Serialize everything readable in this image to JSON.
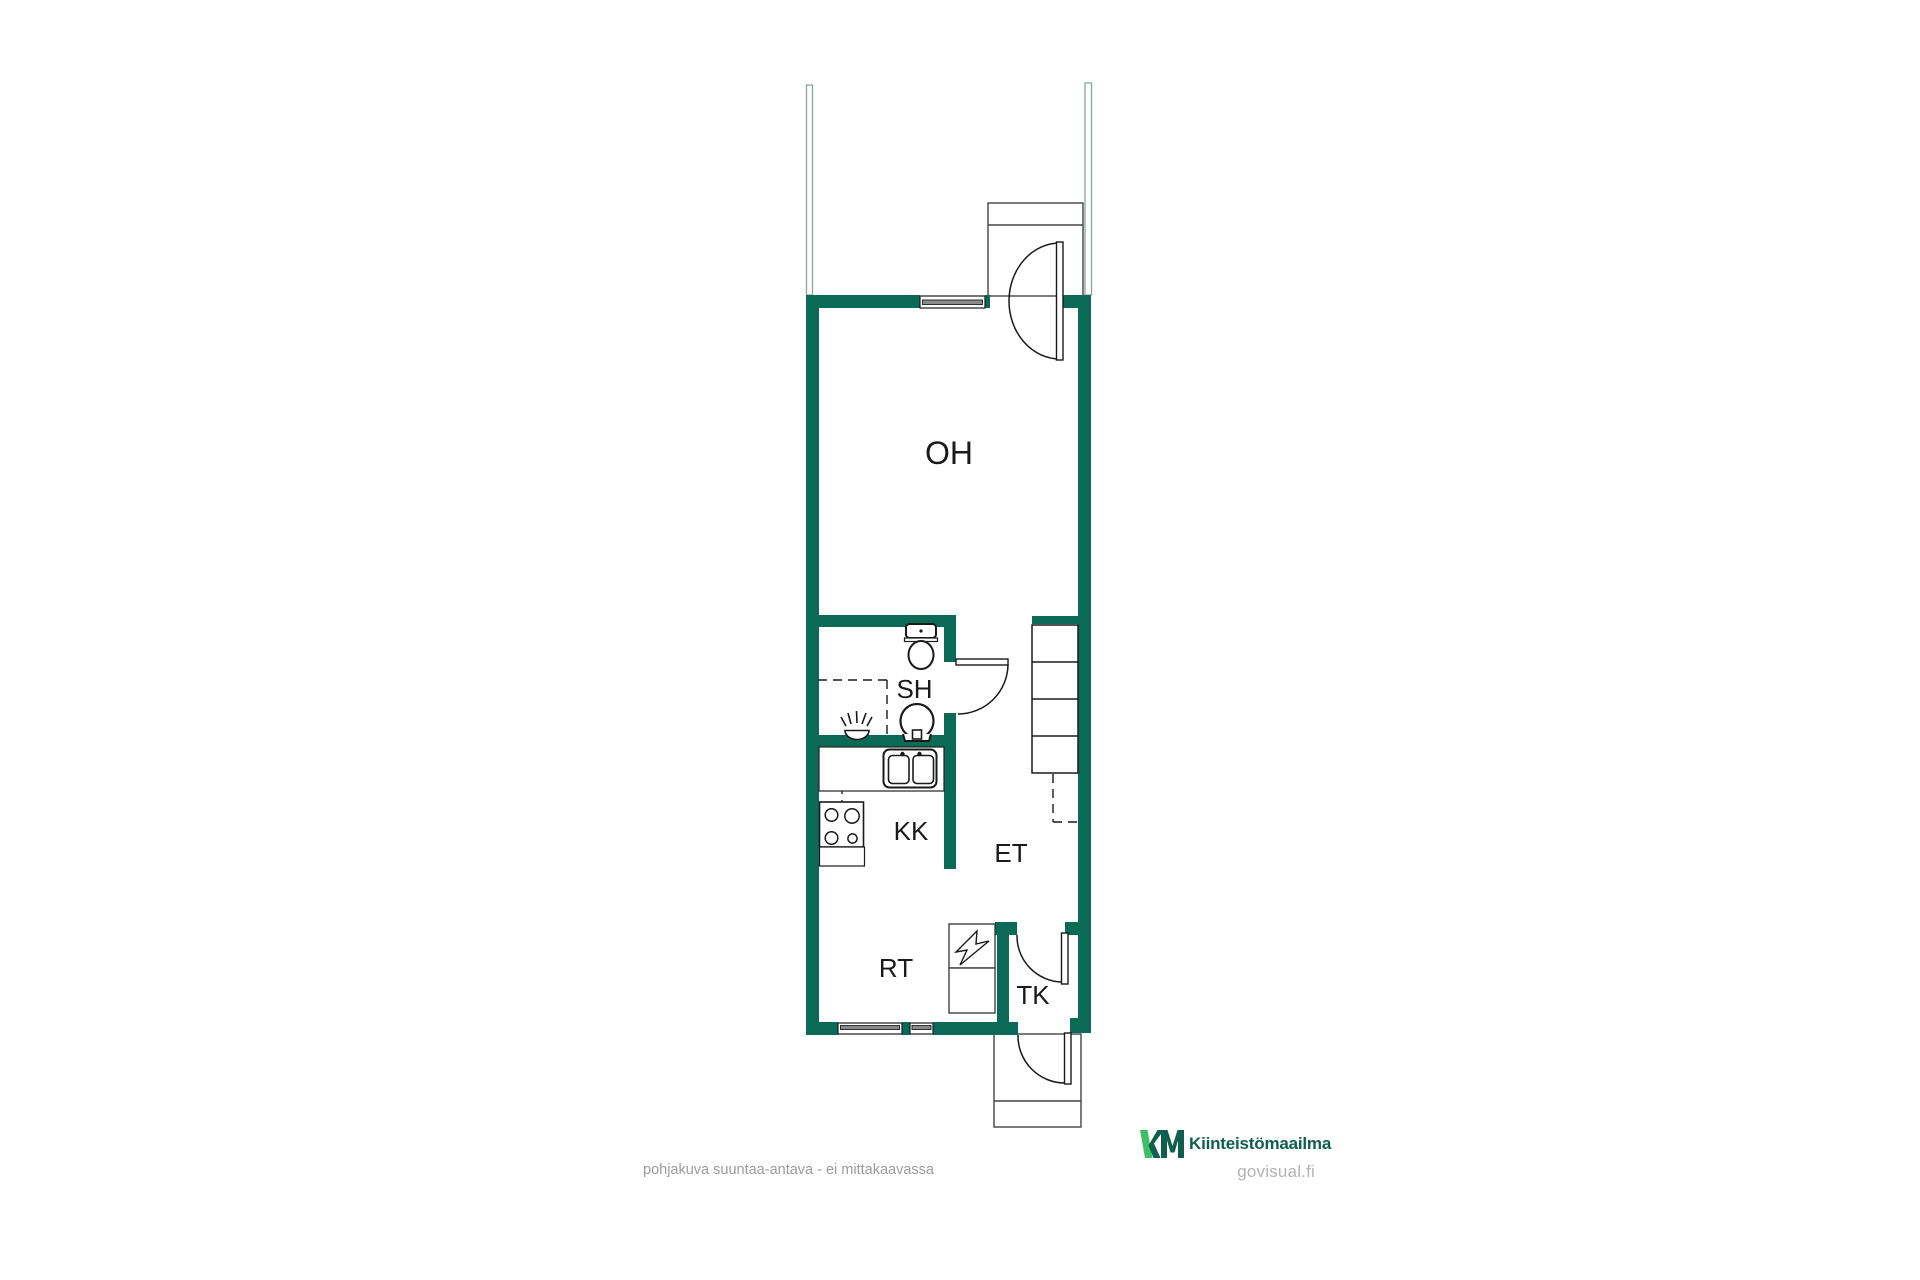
{
  "floorplan": {
    "room_labels": [
      {
        "code": "OH"
      },
      {
        "code": "SH"
      },
      {
        "code": "KK"
      },
      {
        "code": "ET"
      },
      {
        "code": "RT"
      },
      {
        "code": "TK"
      }
    ],
    "disclaimer": "pohjakuva suuntaa-antava - ei mittakaavassa"
  },
  "branding": {
    "monogram": "KM",
    "company": "Kiinteistömaailma",
    "watermark": "govisual.fi"
  },
  "colors": {
    "wall_green": "#0a6a55",
    "line_black": "#1a1a1a",
    "porch_gray": "#444444",
    "fence_gray_green": "#8fa39b",
    "window_band_gray": "#8a8a8a",
    "disclaimer_gray": "#9c9c9c",
    "watermark_gray": "#b4b4b4",
    "logo_dark_green": "#0e5f4e",
    "logo_bright_green": "#3ebf66"
  }
}
